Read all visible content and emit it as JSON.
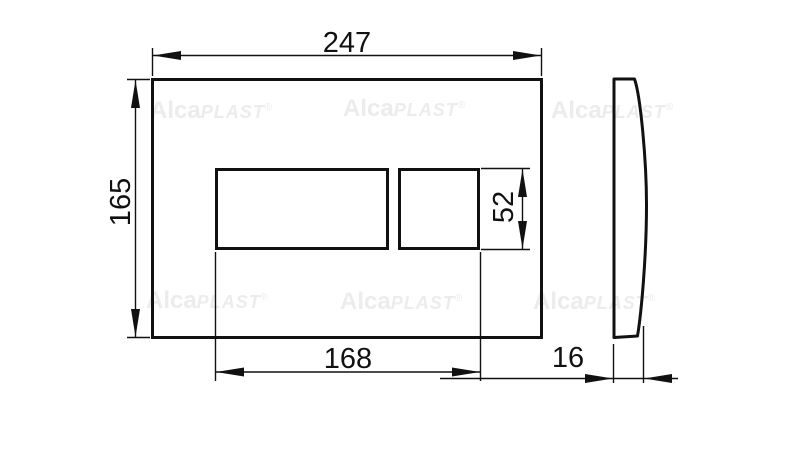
{
  "drawing": {
    "type": "technical dimension drawing",
    "subject": "flush plate front view and side view",
    "line_color": "#111111",
    "watermark_color": "#ececec",
    "dims": {
      "plate_width": "247",
      "plate_height": "165",
      "button_area_width": "168",
      "button_height": "52",
      "plate_depth": "16"
    },
    "watermark": {
      "bold": "Alca",
      "caps": "PLAST",
      "reg": "®"
    }
  }
}
